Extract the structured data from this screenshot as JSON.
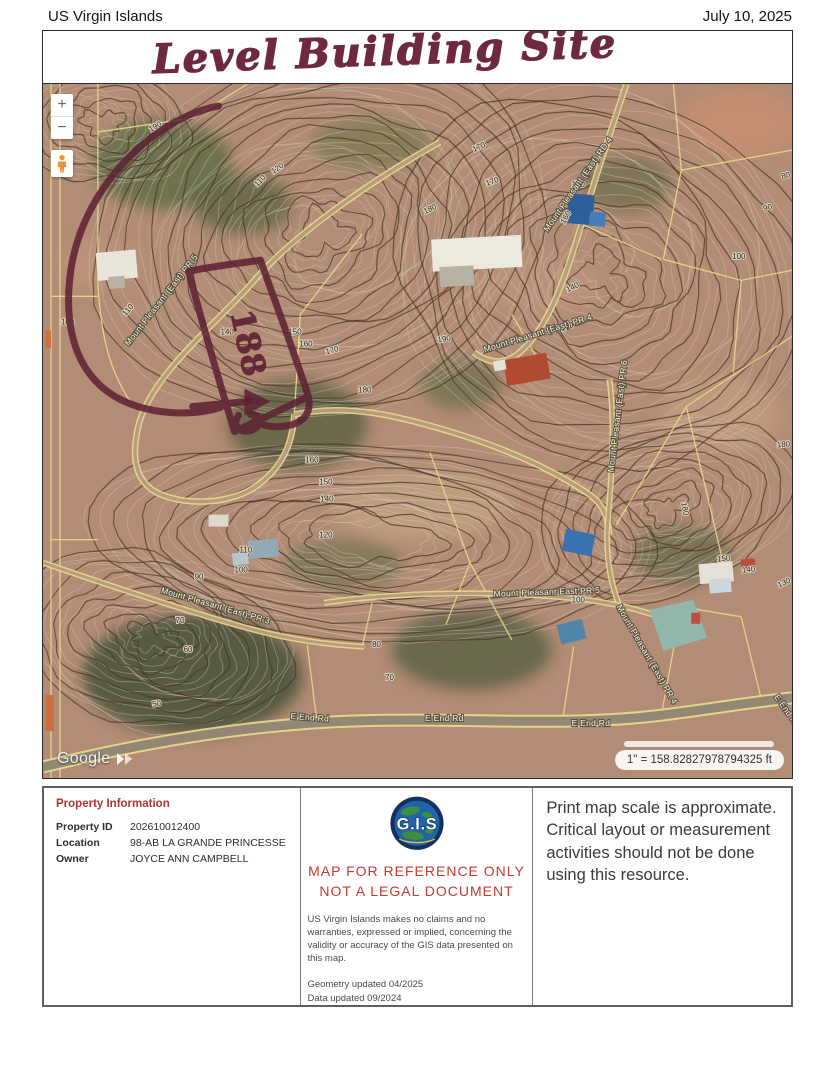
{
  "header": {
    "region": "US Virgin Islands",
    "date": "July 10, 2025"
  },
  "annotation": {
    "title": "Level Building Site",
    "parcel_label": "188",
    "ink_color": "#5e2133"
  },
  "map": {
    "controls": {
      "zoom_in": "+",
      "zoom_out": "−"
    },
    "attribution": "Google",
    "scale_label": "1\" = 158.82827978794325 ft",
    "colors": {
      "terrain": "#b28c74",
      "contour": "#4a3526",
      "parcel_line": "#ead98f",
      "ink": "#5e2133"
    },
    "road_labels": [
      {
        "text": "Mount Pleasant (East) PR 5",
        "x": 86,
        "y": 262,
        "rot": -52
      },
      {
        "text": "Mount Pleasant (East) RD 4",
        "x": 506,
        "y": 148,
        "rot": -55
      },
      {
        "text": "Mount Pleasant (East) PR 4",
        "x": 443,
        "y": 268,
        "rot": -17
      },
      {
        "text": "Mount Pleasant (East) PR 6",
        "x": 572,
        "y": 388,
        "rot": -83
      },
      {
        "text": "Mount Pleasant East PR 5",
        "x": 452,
        "y": 512,
        "rot": -2
      },
      {
        "text": "Mount Pleasant (East) PR 4",
        "x": 575,
        "y": 522,
        "rot": 60
      },
      {
        "text": "Mount Pleasant (East) PR 3",
        "x": 118,
        "y": 508,
        "rot": 16
      },
      {
        "text": "E End Rd",
        "x": 248,
        "y": 634,
        "rot": 4
      },
      {
        "text": "E End Rd",
        "x": 383,
        "y": 636,
        "rot": 0
      },
      {
        "text": "E End Rd",
        "x": 530,
        "y": 641,
        "rot": 0
      },
      {
        "text": "E End Rd",
        "x": 733,
        "y": 612,
        "rot": 55
      }
    ],
    "contour_labels": [
      {
        "t": "120",
        "x": 231,
        "y": 90,
        "r": -35
      },
      {
        "t": "110",
        "x": 215,
        "y": 103,
        "r": -45
      },
      {
        "t": "100",
        "x": 18,
        "y": 240,
        "r": 0
      },
      {
        "t": "110",
        "x": 83,
        "y": 232,
        "r": -50
      },
      {
        "t": "140",
        "x": 178,
        "y": 250,
        "r": 0
      },
      {
        "t": "150",
        "x": 246,
        "y": 250,
        "r": 0
      },
      {
        "t": "160",
        "x": 257,
        "y": 262,
        "r": 0
      },
      {
        "t": "170",
        "x": 284,
        "y": 270,
        "r": -15
      },
      {
        "t": "180",
        "x": 316,
        "y": 308,
        "r": 0
      },
      {
        "t": "190",
        "x": 396,
        "y": 258,
        "r": -8
      },
      {
        "t": "170",
        "x": 445,
        "y": 102,
        "r": -20
      },
      {
        "t": "180",
        "x": 383,
        "y": 130,
        "r": -25
      },
      {
        "t": "150",
        "x": 530,
        "y": 103,
        "r": 0
      },
      {
        "t": "160",
        "x": 523,
        "y": 140,
        "r": -60
      },
      {
        "t": "140",
        "x": 526,
        "y": 208,
        "r": -25
      },
      {
        "t": "170",
        "x": 520,
        "y": 247,
        "r": -20
      },
      {
        "t": "80",
        "x": 741,
        "y": 95,
        "r": -15
      },
      {
        "t": "90",
        "x": 723,
        "y": 127,
        "r": -15
      },
      {
        "t": "100",
        "x": 691,
        "y": 175,
        "r": 0
      },
      {
        "t": "180",
        "x": 736,
        "y": 363,
        "r": -5
      },
      {
        "t": "180",
        "x": 640,
        "y": 418,
        "r": 80
      },
      {
        "t": "150",
        "x": 676,
        "y": 477,
        "r": -5
      },
      {
        "t": "140",
        "x": 701,
        "y": 488,
        "r": -5
      },
      {
        "t": "130",
        "x": 738,
        "y": 503,
        "r": -25
      },
      {
        "t": "100",
        "x": 530,
        "y": 518,
        "r": 0
      },
      {
        "t": "80",
        "x": 330,
        "y": 562,
        "r": 0
      },
      {
        "t": "70",
        "x": 343,
        "y": 595,
        "r": 0
      },
      {
        "t": "160",
        "x": 263,
        "y": 378,
        "r": 0
      },
      {
        "t": "150",
        "x": 277,
        "y": 400,
        "r": 0
      },
      {
        "t": "140",
        "x": 278,
        "y": 417,
        "r": 0
      },
      {
        "t": "120",
        "x": 277,
        "y": 453,
        "r": 0
      },
      {
        "t": "110",
        "x": 197,
        "y": 468,
        "r": 0
      },
      {
        "t": "100",
        "x": 192,
        "y": 488,
        "r": 0
      },
      {
        "t": "90",
        "x": 152,
        "y": 495,
        "r": 0
      },
      {
        "t": "70",
        "x": 133,
        "y": 538,
        "r": 0
      },
      {
        "t": "60",
        "x": 141,
        "y": 567,
        "r": 0
      },
      {
        "t": "50",
        "x": 110,
        "y": 622,
        "r": -10
      },
      {
        "t": "170",
        "x": 432,
        "y": 68,
        "r": -25
      },
      {
        "t": "190",
        "x": 108,
        "y": 48,
        "r": -30
      }
    ]
  },
  "info_panel": {
    "property": {
      "title": "Property Information",
      "rows": [
        {
          "label": "Property ID",
          "value": "202610012400"
        },
        {
          "label": "Location",
          "value": "98-AB LA GRANDE PRINCESSE"
        },
        {
          "label": "Owner",
          "value": "JOYCE ANN CAMPBELL"
        }
      ]
    },
    "reference": {
      "logo_text": "G.I.S",
      "line1": "MAP FOR REFERENCE ONLY",
      "line2": "NOT A LEGAL DOCUMENT",
      "disclaimer": "US Virgin Islands makes no claims and no warranties, expressed or implied, concerning the validity or accuracy of the GIS data presented on this map.",
      "geometry_updated": "Geometry updated 04/2025",
      "data_updated": "Data updated 09/2024"
    },
    "scale_note": "Print map scale is approximate. Critical layout or measurement activities should not be done using this resource."
  }
}
